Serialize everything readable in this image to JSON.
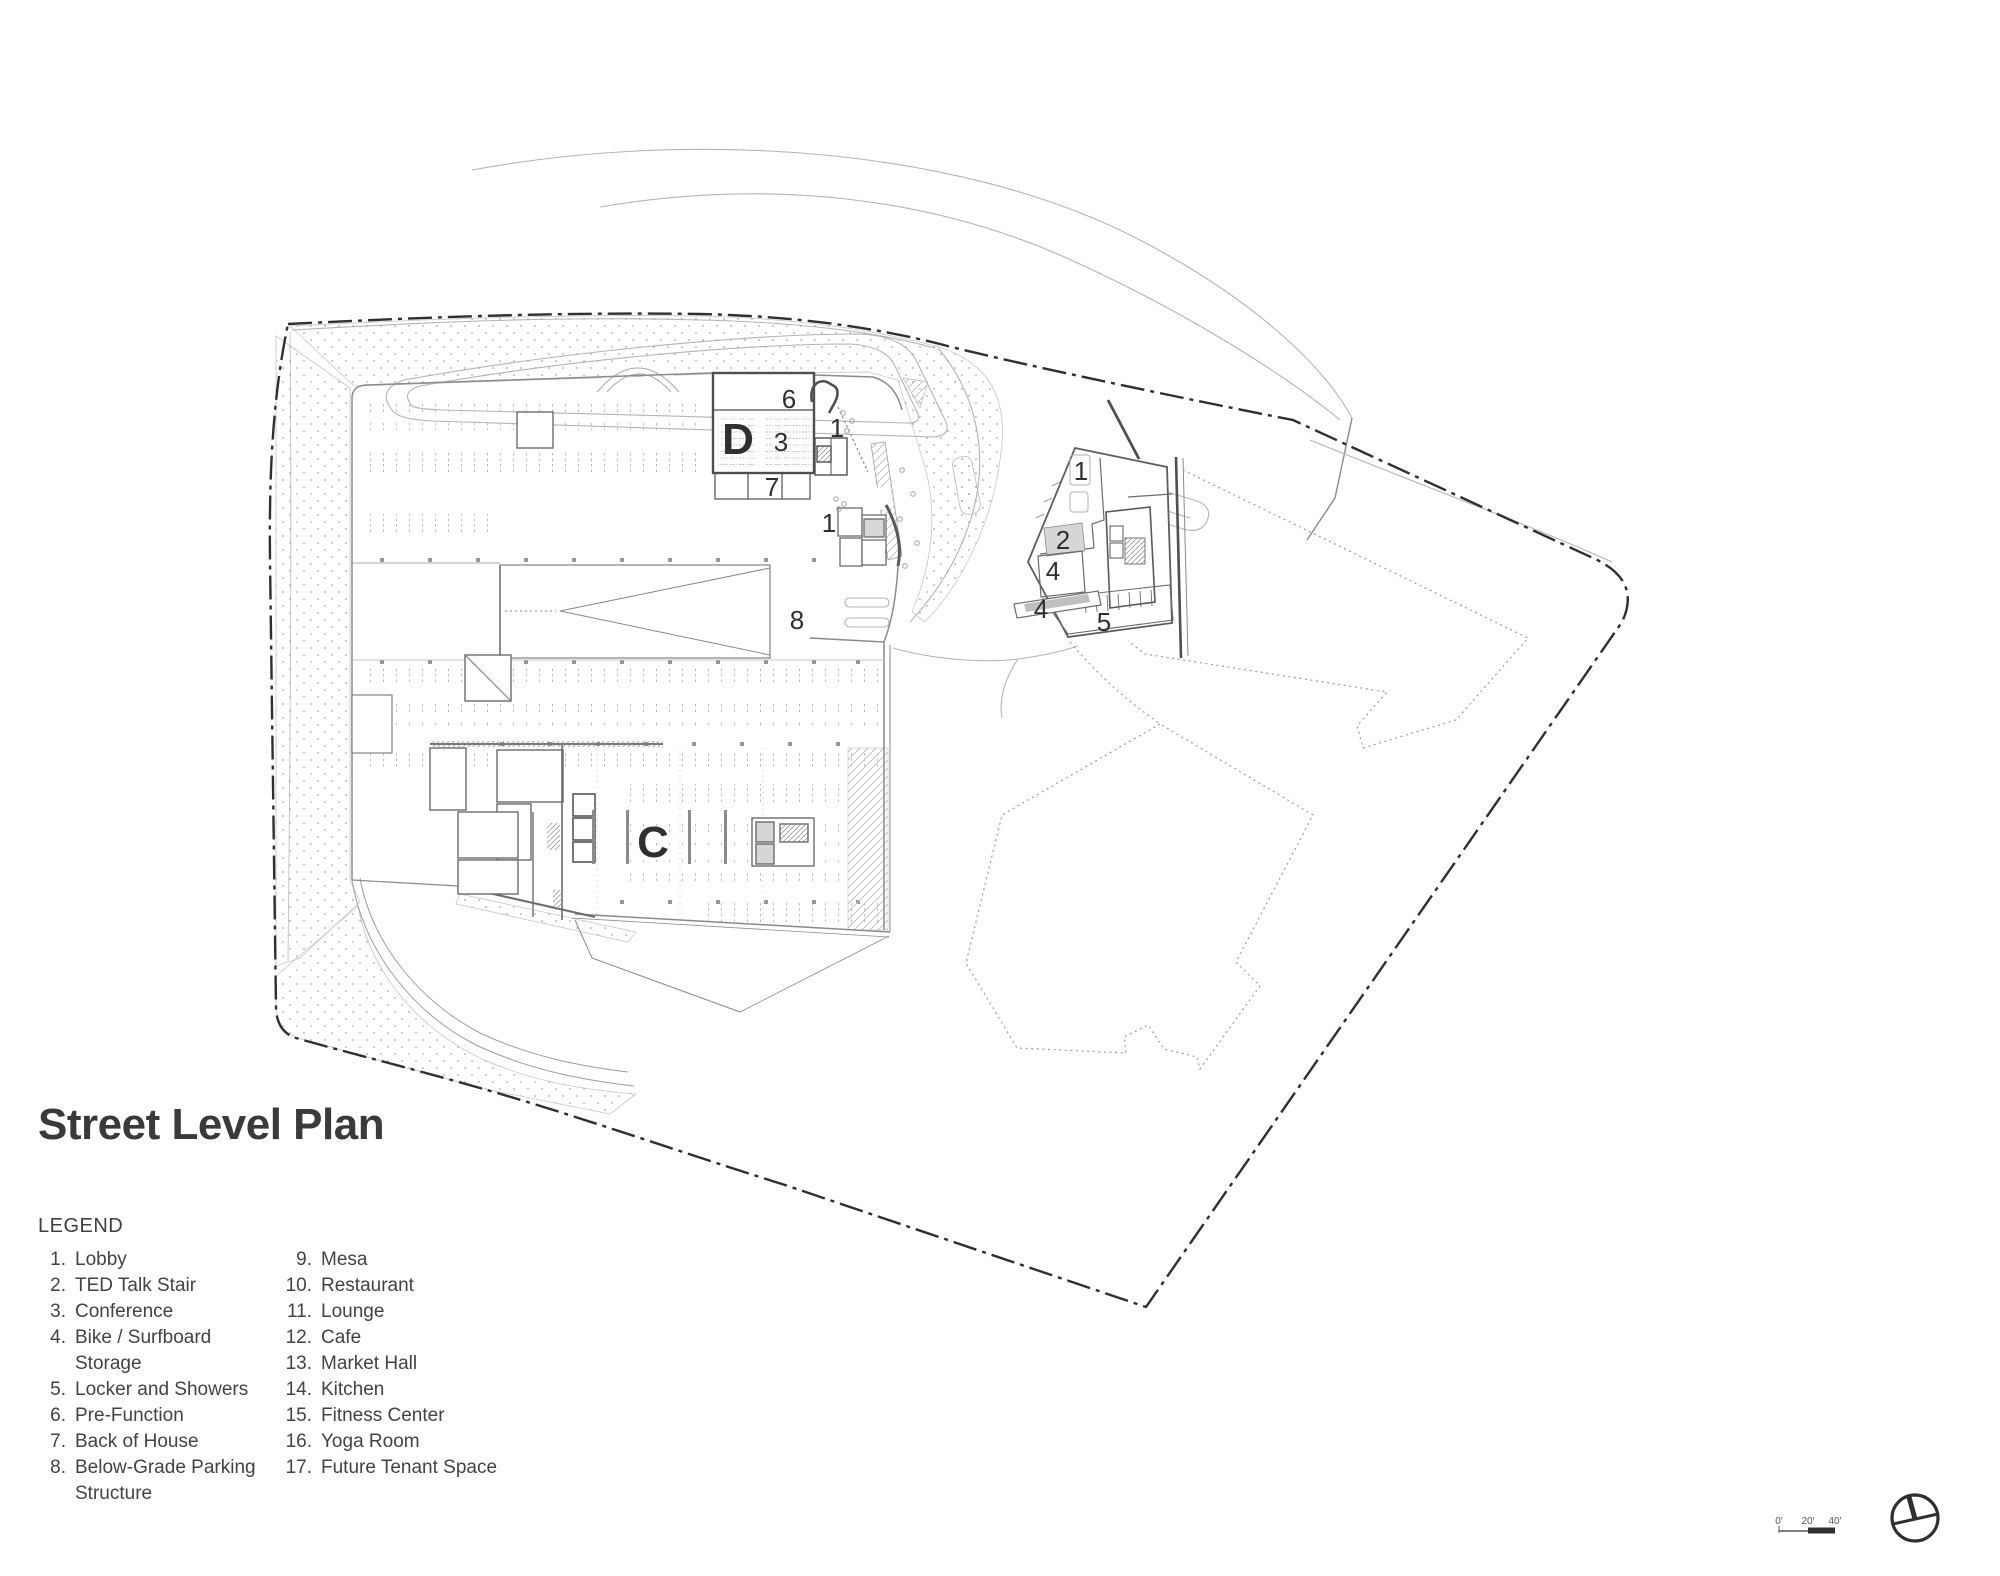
{
  "title": "Street Level Plan",
  "legend": {
    "heading": "LEGEND",
    "col1": [
      {
        "num": "1.",
        "label": "Lobby"
      },
      {
        "num": "2.",
        "label": "TED Talk Stair"
      },
      {
        "num": "3.",
        "label": "Conference"
      },
      {
        "num": "4.",
        "label": "Bike / Surfboard",
        "label2": "Storage"
      },
      {
        "num": "5.",
        "label": "Locker and Showers"
      },
      {
        "num": "6.",
        "label": "Pre-Function"
      },
      {
        "num": "7.",
        "label": "Back of House"
      },
      {
        "num": "8.",
        "label": "Below-Grade Parking",
        "label2": "Structure"
      }
    ],
    "col2": [
      {
        "num": "9.",
        "label": "Mesa"
      },
      {
        "num": "10.",
        "label": "Restaurant"
      },
      {
        "num": "11.",
        "label": "Lounge"
      },
      {
        "num": "12.",
        "label": "Cafe"
      },
      {
        "num": "13.",
        "label": "Market Hall"
      },
      {
        "num": "14.",
        "label": "Kitchen"
      },
      {
        "num": "15.",
        "label": "Fitness Center"
      },
      {
        "num": "16.",
        "label": "Yoga Room"
      },
      {
        "num": "17.",
        "label": "Future Tenant Space"
      }
    ]
  },
  "plan": {
    "building_labels": [
      {
        "text": "D"
      },
      {
        "text": "C"
      }
    ],
    "annotations": [
      {
        "text": "6"
      },
      {
        "text": "1"
      },
      {
        "text": "3"
      },
      {
        "text": "7"
      },
      {
        "text": "1"
      },
      {
        "text": "8"
      },
      {
        "text": "1"
      },
      {
        "text": "2"
      },
      {
        "text": "4"
      },
      {
        "text": "4"
      },
      {
        "text": "5"
      }
    ]
  },
  "scale_bar": {
    "labels": [
      "0'",
      "20'",
      "40'"
    ]
  },
  "colors": {
    "ink": "#2f2f31",
    "line_mid": "#8b8b8e",
    "line_light": "#b4b4b7"
  }
}
